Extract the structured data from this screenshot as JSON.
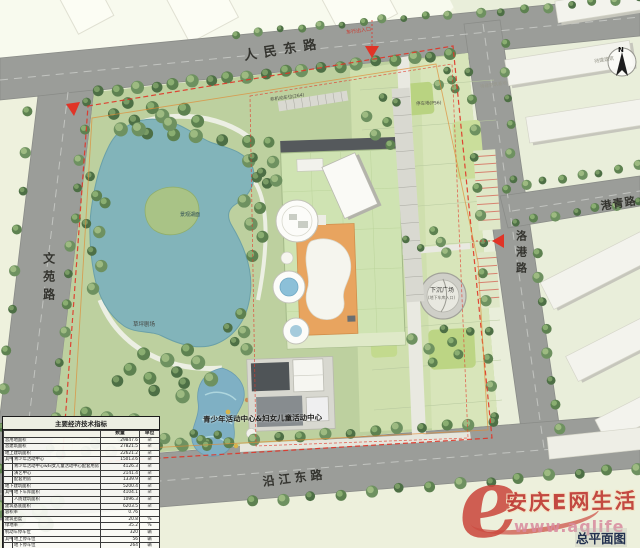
{
  "roads": {
    "renmin": "人民东路",
    "wenyuan": "文苑路",
    "gangqing": "港青路",
    "luogang": "洛港路",
    "yanjiang": "沿江东路"
  },
  "site_labels": {
    "building_caption": "青少年活动中心&妇女儿童活动中心",
    "sunken_plaza": "下沉广场",
    "sunken_plaza_sub": "(地下车库入口)",
    "lawn_theater": "草坪剧场",
    "lake": "景观湖面",
    "vehicle_entrance": "车行出入口",
    "parking": "停车场(P56)",
    "bike_parking": "非机动车位(264)",
    "ne_plot": "待建建筑",
    "e_plot": "待建建筑基地"
  },
  "compass": {
    "north": "N"
  },
  "table": {
    "title": "主要经济技术指标",
    "col_qty": "数量",
    "col_unit": "单位",
    "rows": [
      {
        "label": "总用地面积",
        "qty": "29847.6",
        "unit": "㎡"
      },
      {
        "label": "总建筑面积",
        "qty": "27821.5",
        "unit": "㎡"
      },
      {
        "label": "地上建筑面积",
        "qty": "22621.2",
        "unit": "㎡"
      },
      {
        "group": "其中",
        "label": "青少年活动中心",
        "qty": "15013.6",
        "unit": "㎡"
      },
      {
        "group": "",
        "label": "青少年活动中心&妇女儿童活动中心配套用房",
        "qty": "4126.3",
        "unit": "㎡"
      },
      {
        "group": "",
        "label": "演艺中心",
        "qty": "2141.4",
        "unit": "㎡"
      },
      {
        "group": "",
        "label": "配套用房",
        "qty": "1339.9",
        "unit": "㎡"
      },
      {
        "label": "地下建筑面积",
        "qty": "5200.4",
        "unit": "㎡"
      },
      {
        "group": "其中",
        "label": "地下车库面积",
        "qty": "4104.1",
        "unit": "㎡"
      },
      {
        "group": "",
        "label": "人防建筑面积",
        "qty": "1096.3",
        "unit": "㎡"
      },
      {
        "label": "建筑基底面积",
        "qty": "6203.5",
        "unit": "㎡"
      },
      {
        "label": "容积率",
        "qty": "0.76",
        "unit": ""
      },
      {
        "label": "建筑密度",
        "qty": "20.8",
        "unit": "%"
      },
      {
        "label": "绿地率",
        "qty": "35.2",
        "unit": "%"
      },
      {
        "label": "机动车停车位",
        "qty": "320",
        "unit": "辆"
      },
      {
        "group": "其中",
        "label": "地上停车位",
        "qty": "56",
        "unit": "辆"
      },
      {
        "group": "",
        "label": "地下停车位",
        "qty": "264",
        "unit": "辆"
      }
    ]
  },
  "watermark": {
    "e": "e",
    "brand": "安庆E网生活",
    "url": "www.aqlife",
    "caption": "总平面图"
  }
}
